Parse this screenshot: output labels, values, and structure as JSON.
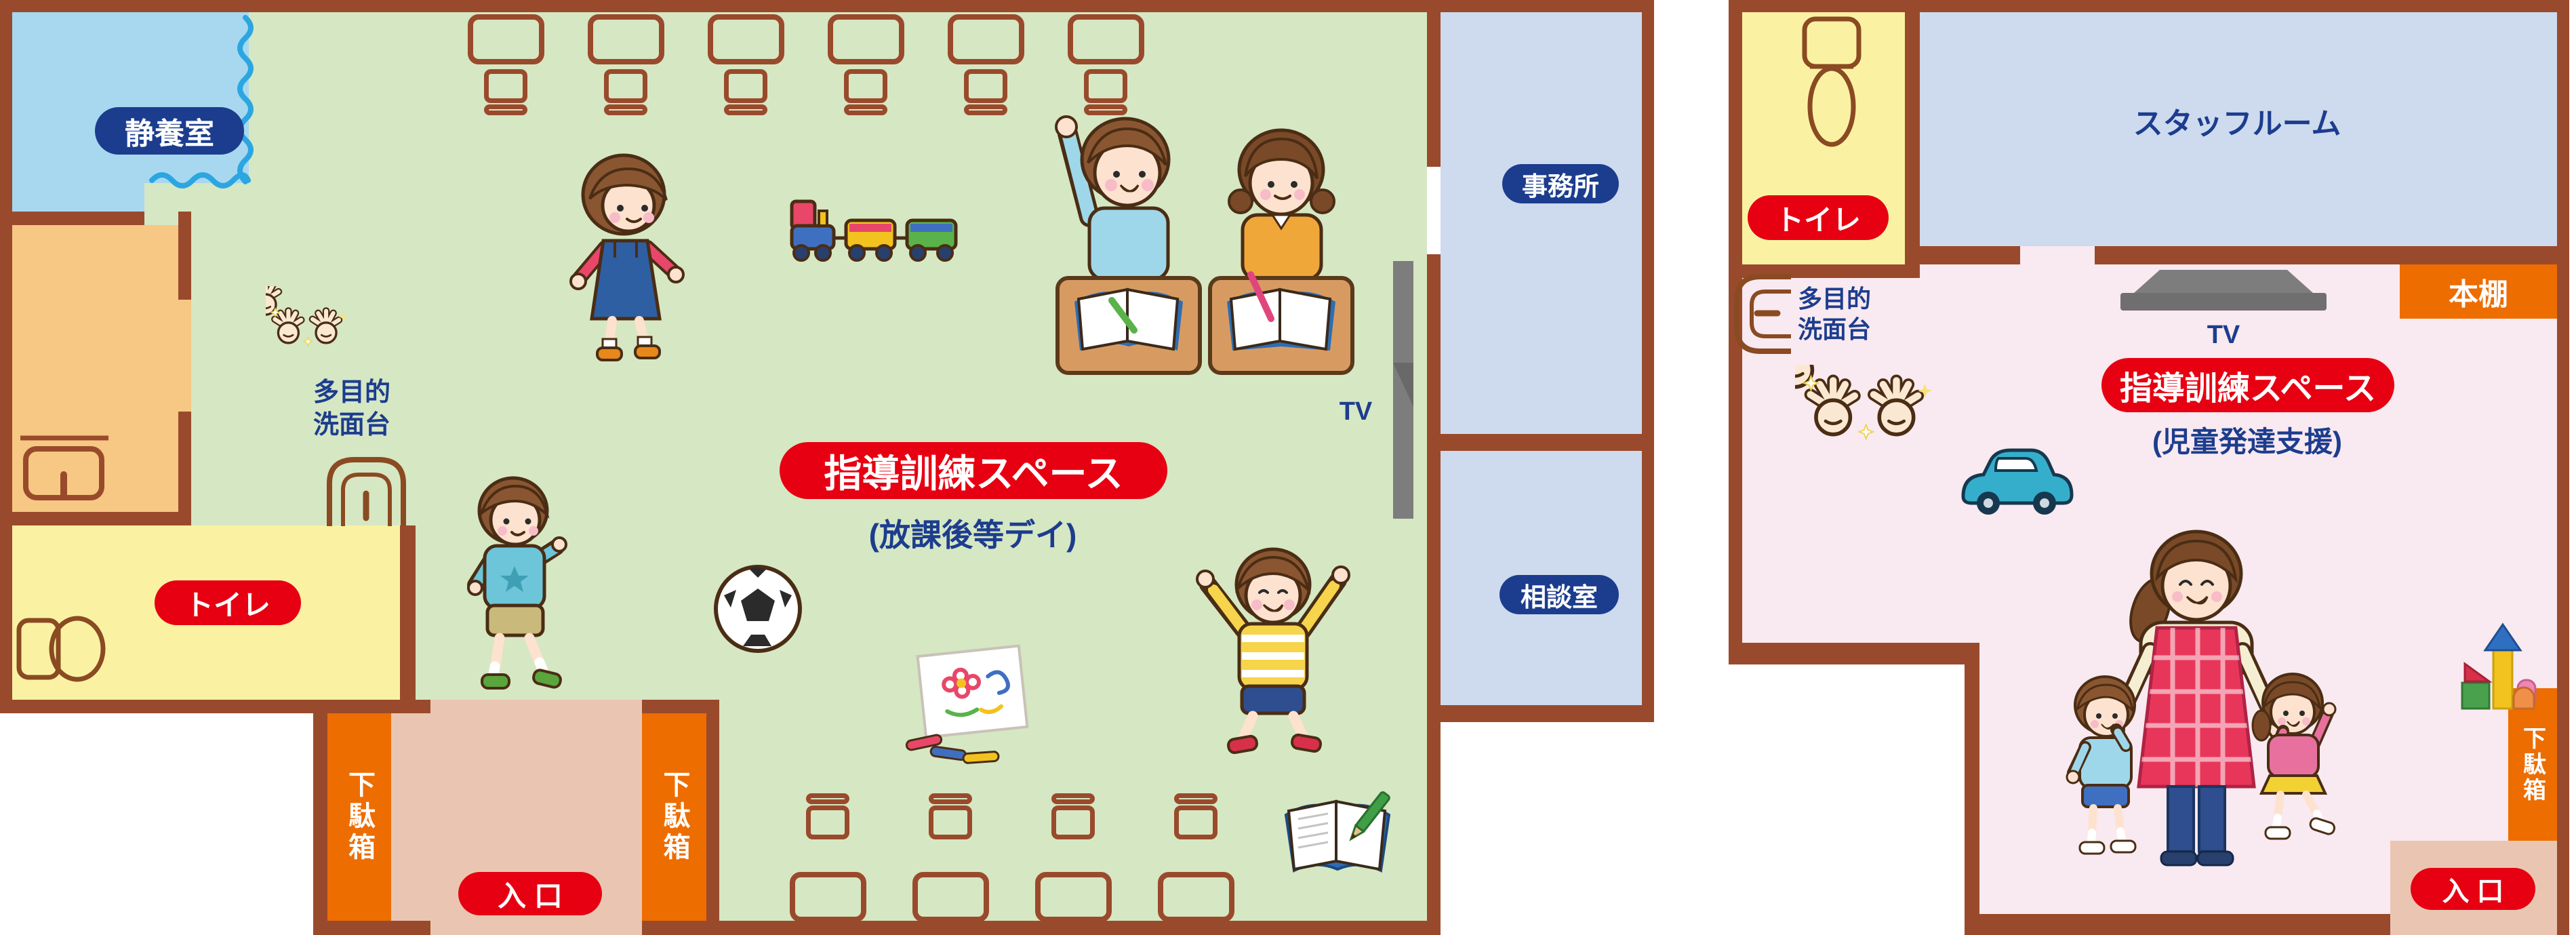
{
  "colors": {
    "wall_brown": "#9a4a2c",
    "floor_green": "#d6e7c3",
    "rest_room_blue": "#a7d8f0",
    "storage_orange": "#f6c883",
    "toilet_yellow": "#faf2a2",
    "entry_salmon": "#eac6b2",
    "shoebox_orange": "#ed6d00",
    "office_lavender": "#cedaee",
    "training_pink": "#f9e9f0",
    "label_red": "#e60012",
    "label_navy": "#1c3d8e",
    "curtain_blue": "#2ca6e0",
    "tv_gray": "#7d7d7d"
  },
  "left": {
    "rest_room": "静養室",
    "toilet": "トイレ",
    "sink_line1": "多目的",
    "sink_line2": "洗面台",
    "training_title": "指導訓練スペース",
    "training_subtitle": "(放課後等デイ)",
    "office": "事務所",
    "consult": "相談室",
    "tv": "TV",
    "shoebox_left": "下駄箱",
    "shoebox_right": "下駄箱",
    "entrance": "入 口"
  },
  "right": {
    "toilet": "トイレ",
    "staff_room": "スタッフルーム",
    "bookshelf": "本棚",
    "tv": "TV",
    "sink_line1": "多目的",
    "sink_line2": "洗面台",
    "training_title": "指導訓練スペース",
    "training_subtitle": "(児童発達支援)",
    "shoebox": "下駄箱",
    "entrance": "入 口"
  },
  "icons": {
    "curtain-wave-icon": "wavy blue curtain divider",
    "sparkle-hands-icon": "two clean sparkling hands",
    "sink-icon": "multipurpose washbasin (top view)",
    "toilet-icon": "toilet (top view)",
    "desk-icon": "desk (top view outline)",
    "chair-icon": "chair (top view outline)",
    "tv-icon": "wall-mounted television",
    "girl-walking-illustration": "girl in pink shirt and navy jumper",
    "toy-train-illustration": "colorful toy train",
    "kids-at-desks-illustration": "boy raising hand and girl writing at desks",
    "boy-walking-illustration": "boy in teal shirt walking to entrance",
    "soccer-ball-icon": "soccer ball",
    "drawing-illustration": "drawing paper with markers",
    "boy-jumping-illustration": "cheering boy in striped shirt",
    "notebook-icon": "open notebook with green pencil",
    "car-toy-icon": "teal toy car",
    "blocks-icon": "stacked building blocks",
    "teacher-children-illustration": "teacher in gingham apron holding hands with boy and girl"
  }
}
